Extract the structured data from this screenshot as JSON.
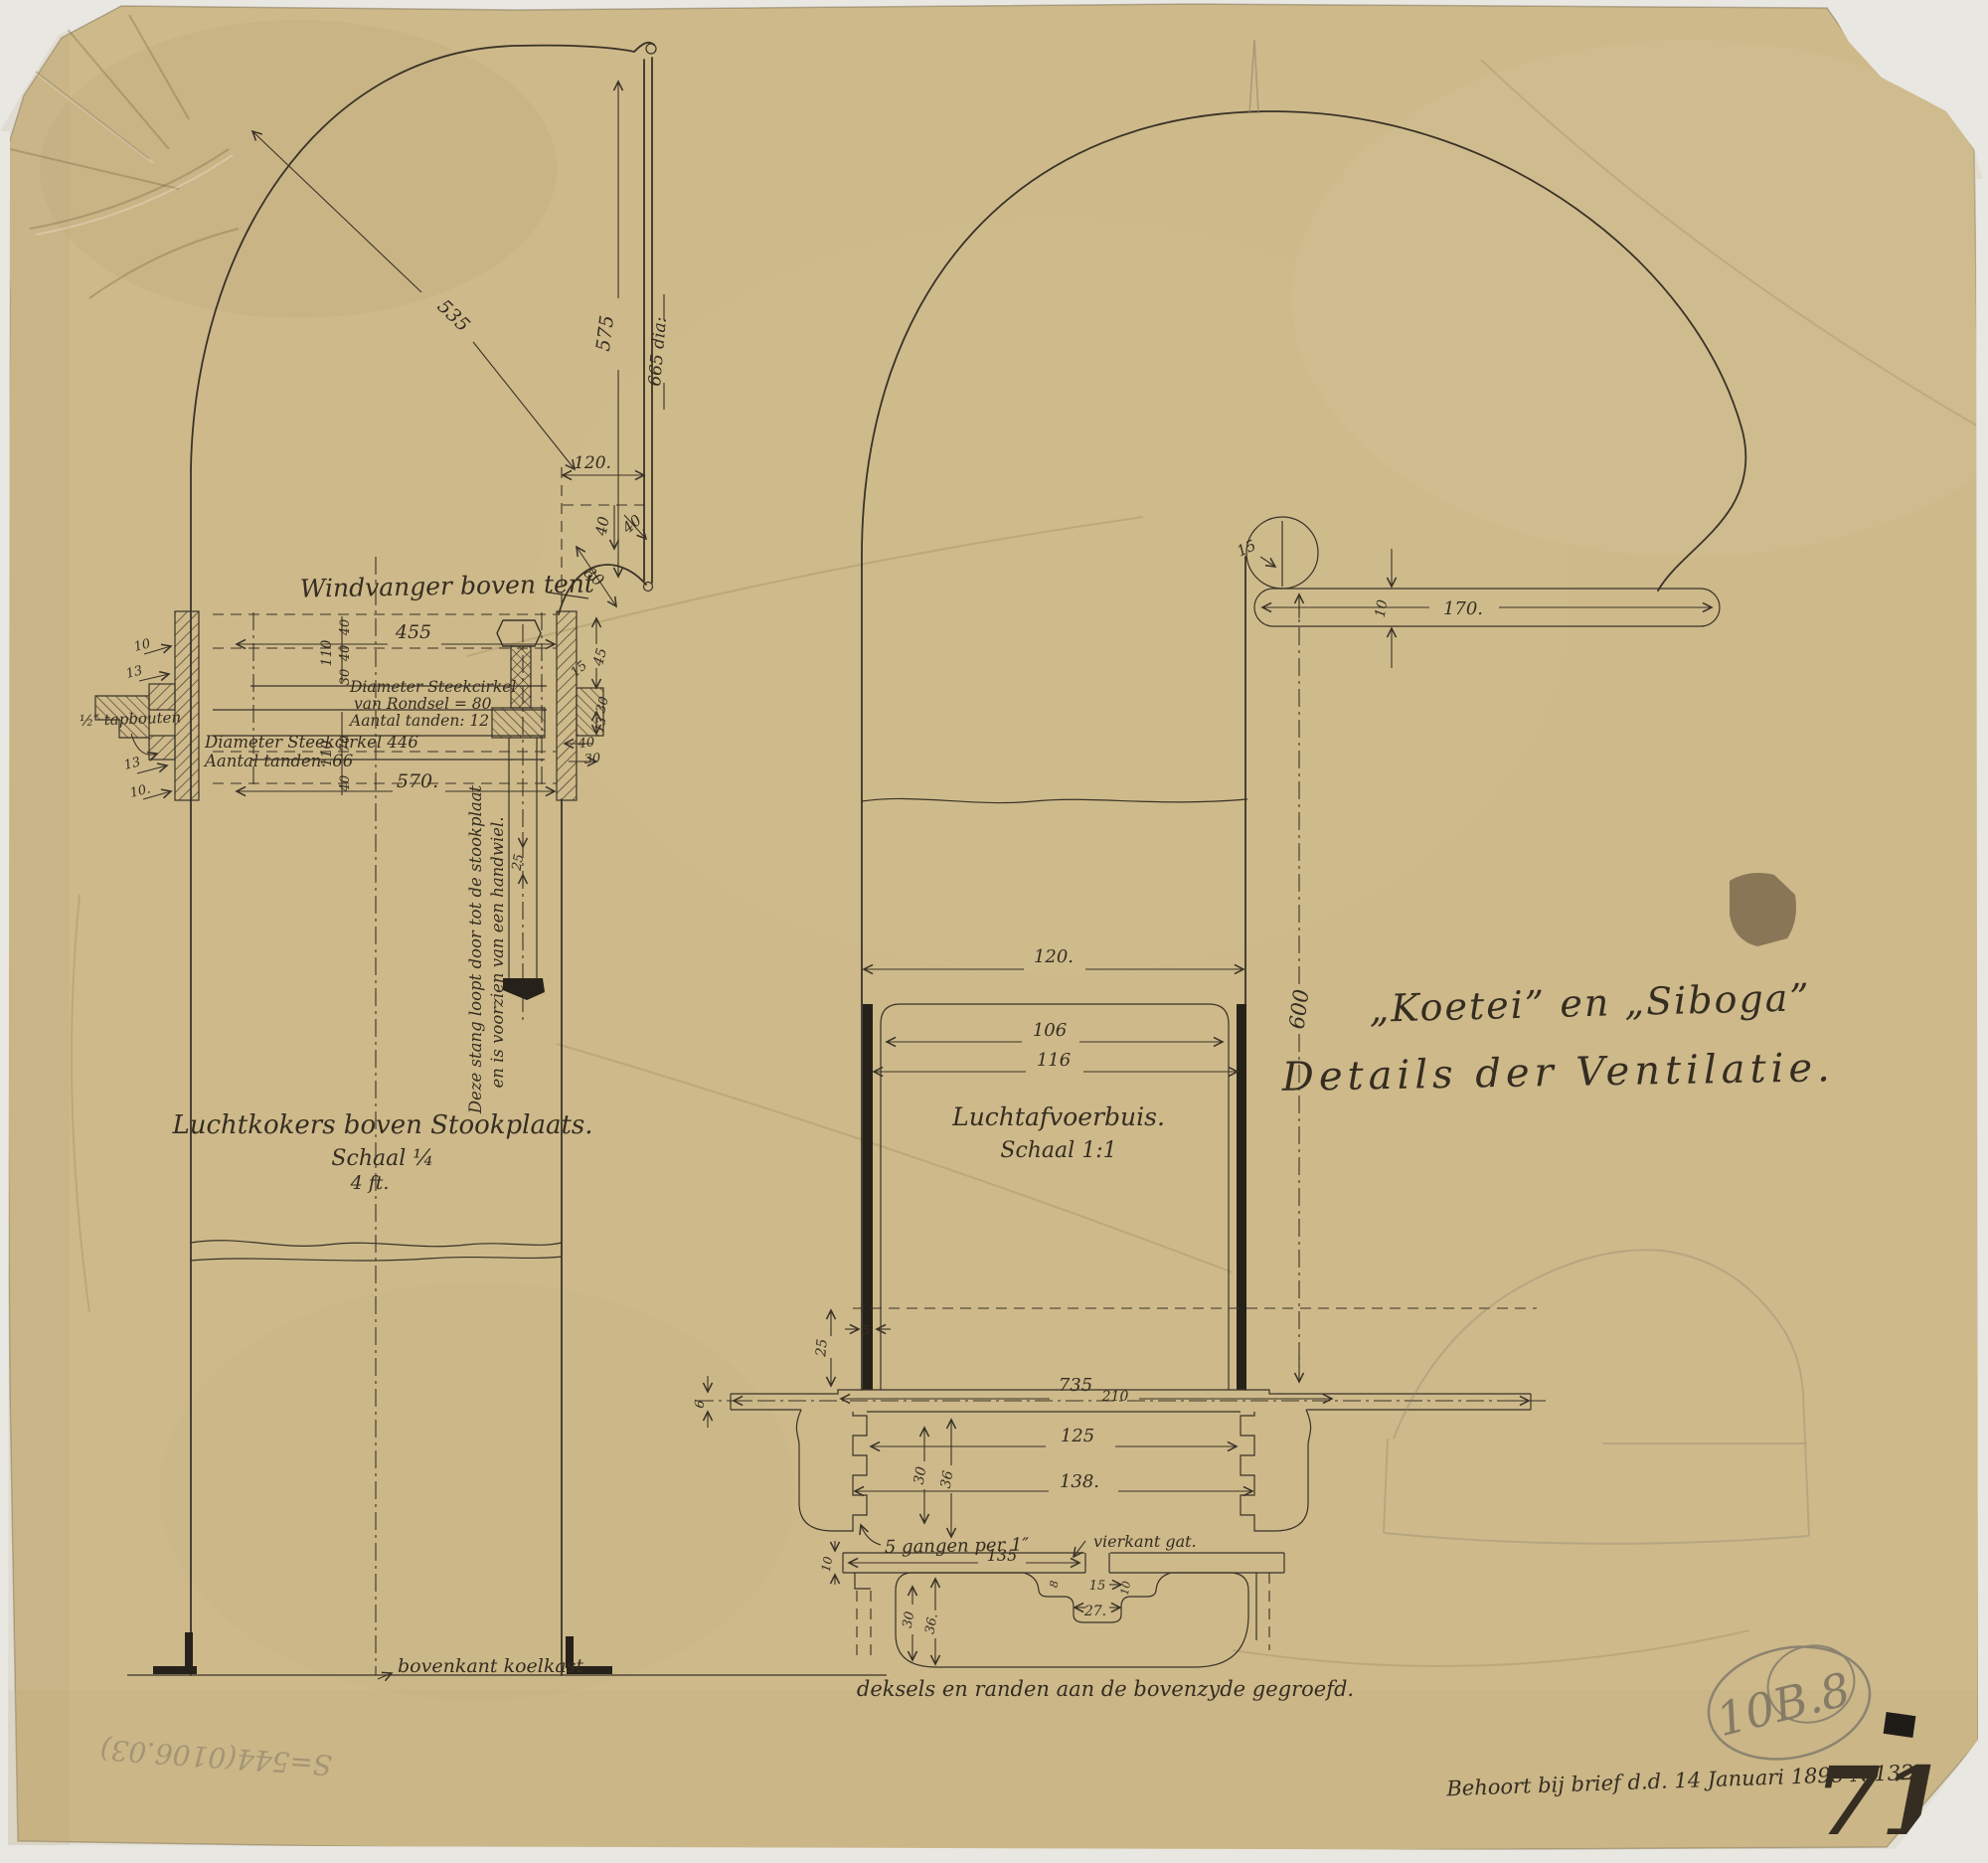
{
  "sheet": {
    "title_line1": "„Koetei” en „Siboga”",
    "title_line2": "Details der Ventilatie.",
    "footer_note": "Behoort bij brief d.d. 14 Januari 1898 N.132.",
    "archive_ref": "10B.8",
    "stamp_number": "71",
    "pencil_inscription": "S=544(0106.03)",
    "colors": {
      "ink": "#3a3227",
      "paper": "#cdb98a",
      "pencil": "#8d8370",
      "stamp": "#1f1c18"
    }
  },
  "left_view": {
    "caption": "Windvanger boven tent",
    "title_line1": "Luchtkokers boven Stookplaats.",
    "title_line2": "Schaal ¼",
    "title_line3": "4 ft.",
    "baseline_label": "bovenkant koelkast",
    "rod_note_line1": "Deze stang loopt door tot de stookplaat",
    "rod_note_line2": "en is voorzien van een handwiel.",
    "gear_note_small_1": "Diameter Steekcirkel",
    "gear_note_small_2": "van Rondsel = 80",
    "gear_note_small_3": "Aantal tanden: 12",
    "gear_note_large_1": "Diameter Steekcirkel 446",
    "gear_note_large_2": "Aantal tanden: 66",
    "bolt_label": "½″ tapbouten",
    "dims": {
      "bend_radius": "535",
      "mouth_height": "575",
      "mouth_diameter": "665 dia:",
      "neck_width": "120.",
      "lip_offset": "40",
      "lip_radius_small": "40",
      "lip_radius_large": "80",
      "flange_width_top": "455",
      "flange_width_bottom": "570.",
      "chain_top": [
        "110",
        "40",
        "40",
        "30"
      ],
      "chain_bottom": [
        "110",
        "70",
        "40"
      ],
      "left_edge": [
        "10",
        "13",
        "13",
        "10."
      ],
      "right_edge": [
        "45",
        "15",
        "30",
        "13",
        "40",
        "30"
      ],
      "rod_width": "25"
    }
  },
  "center_view": {
    "title_line1": "Luchtafvoerbuis.",
    "title_line2": "Schaal 1:1",
    "thread_note": "5 gangen per 1″",
    "hole_label": "vierkant gat.",
    "bottom_caption": "deksels en randen aan de bovenzyde gegroefd.",
    "dims": {
      "lip_radius": "15",
      "deck_bar_thickness": "10",
      "deck_bar_length": "170.",
      "duct_width": "120.",
      "tube_inner": "106",
      "tube_outer": "116",
      "duct_height": "600",
      "plate_inset": "25",
      "wall_thickness": "5",
      "plate_thickness": "6",
      "plate_width": "735",
      "plate_center": "210",
      "thread_inner": "125",
      "thread_outer": "138.",
      "collar_depth": "30",
      "collar_height": "36",
      "lid_half_width": "135",
      "hole_width": "15",
      "groove_width": "27.",
      "hole_dim_left": "8",
      "hole_dim_right": "10",
      "lid_depth": "30",
      "lid_height": "36.",
      "lid_plate_thickness": "10"
    }
  }
}
